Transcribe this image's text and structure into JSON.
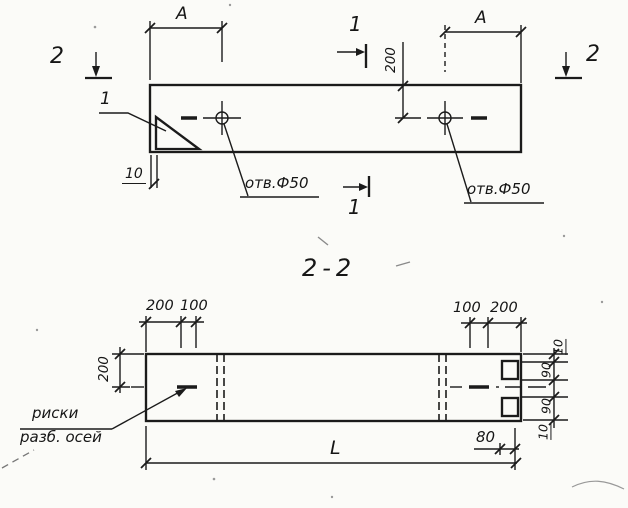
{
  "colors": {
    "ink": "#1b1b1b",
    "paper": "#fbfbf8"
  },
  "top_view": {
    "marker_1_top": "1",
    "marker_1_bottom": "1",
    "marker_2_left": "2",
    "marker_2_right": "2",
    "dim_span_left": "A",
    "dim_span_right": "A",
    "dim_offset_200": "200",
    "dim_thickness_10": "10",
    "detail_callout": "1",
    "hole_label_left": "отв.Ф50",
    "hole_label_right": "отв.Ф50"
  },
  "section_view": {
    "title": "2-2",
    "dim_top_left_200": "200",
    "dim_top_left_100": "100",
    "dim_top_right_100": "100",
    "dim_top_right_200": "200",
    "dim_left_height_200": "200",
    "dim_length_L": "L",
    "dim_end_80": "80",
    "dim_chain_right": [
      "10",
      "90",
      "90",
      "10"
    ],
    "axis_note_line1": "риски",
    "axis_note_line2": "разб. осей"
  }
}
